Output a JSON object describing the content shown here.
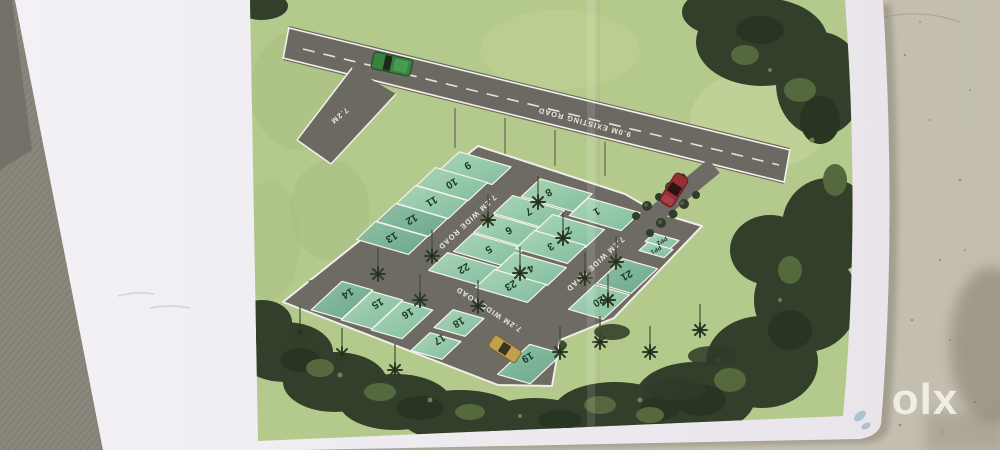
{
  "photo": {
    "watermark": "olx",
    "colors": {
      "table": "#c9c4b5",
      "fabric": "#8b867c",
      "paper": "#efecf1"
    }
  },
  "plan": {
    "existing_road_label": "9.0M EXISTING ROAD",
    "branch_road_label": "7.2M",
    "internal_road_labels": [
      "7.2M WIDE ROAD",
      "7.2M WIDE ROAD",
      "7.2M WIDE ROAD"
    ],
    "plots": [
      {
        "label": "9"
      },
      {
        "label": "10"
      },
      {
        "label": "11"
      },
      {
        "label": "12"
      },
      {
        "label": "13"
      },
      {
        "label": "8"
      },
      {
        "label": "7"
      },
      {
        "label": "6"
      },
      {
        "label": "5"
      },
      {
        "label": "22"
      },
      {
        "label": "1"
      },
      {
        "label": "2"
      },
      {
        "label": "3"
      },
      {
        "label": "4"
      },
      {
        "label": "23"
      },
      {
        "label": "14"
      },
      {
        "label": "15"
      },
      {
        "label": "16"
      },
      {
        "label": "18"
      },
      {
        "label": "17"
      },
      {
        "label": "19"
      },
      {
        "label": "21"
      },
      {
        "label": "20"
      },
      {
        "label": "PP2"
      },
      {
        "label": "PP1"
      }
    ],
    "colors": {
      "lawn": "#b4c98c",
      "plot": "#8ec5a6",
      "road": "#6e6a64",
      "trees": "#33402b",
      "car_green": "#38813f",
      "car_red": "#942f35",
      "car_yellow": "#c2a14c"
    }
  }
}
